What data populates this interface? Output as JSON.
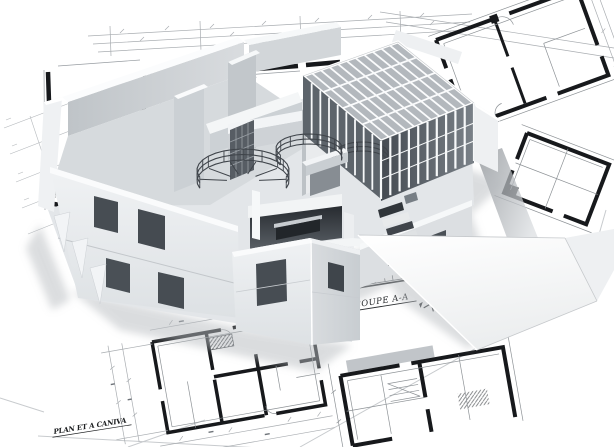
{
  "image": {
    "kind": "architectural-visualization",
    "subject": "White 3D massing model of a modern building with glass atrium and curved stairs, standing on tilted greyscale blueprint floor plans",
    "tone": "greyscale"
  },
  "labels": {
    "section_label": "COUPE A-A",
    "plan_label": "PLAN ET A CANIVA"
  },
  "palette": {
    "background": "#ffffff",
    "model_white": "#fafbfc",
    "model_light": "#e6e9eb",
    "model_mid": "#cdd1d5",
    "model_floor": "#d6dadd",
    "glass_dark": "#50565d",
    "opening_dark": "#474d53",
    "blueprint_line_light": "#b4b8bc",
    "blueprint_line": "#8d9296",
    "blueprint_wall_ink": "#17191c",
    "label_ink": "#212427",
    "shadow": "#b7bbbf"
  }
}
